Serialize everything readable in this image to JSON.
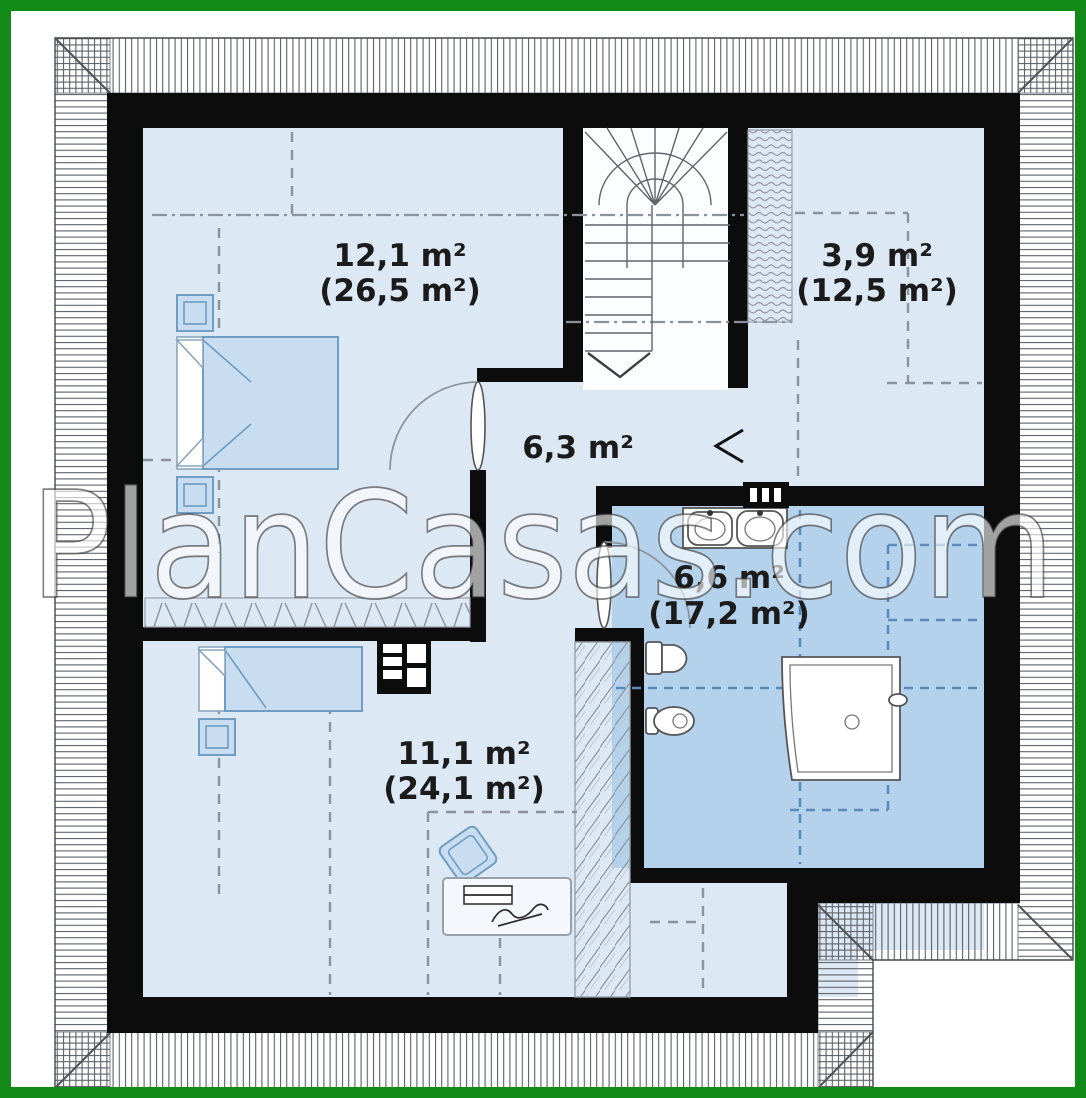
{
  "watermark": "PlanCasas.com",
  "rooms": [
    {
      "name": "bedroom-upper",
      "area": "12,1 m²",
      "floor_area_total": "(26,5 m²)"
    },
    {
      "name": "storage-room",
      "area": "3,9 m²",
      "floor_area_total": "(12,5 m²)"
    },
    {
      "name": "hall",
      "area": "6,3 m²",
      "floor_area_total": ""
    },
    {
      "name": "bathroom",
      "area": "6,6 m²",
      "floor_area_total": "(17,2 m²)"
    },
    {
      "name": "bedroom-lower",
      "area": "11,1 m²",
      "floor_area_total": "(24,1 m²)"
    }
  ],
  "colors": {
    "frame_green": "#128a18",
    "wall_black": "#0c0c0c",
    "floor_light": "#dde8f5",
    "floor_bath": "#b4d2ec",
    "furniture_fill": "#c8ddf0",
    "furniture_stroke": "#6f9cc2",
    "dash_gray": "#8b939e",
    "dash_blue": "#5d89bb",
    "roof_line": "#5b5f66",
    "watermark_fill": "#ffffff"
  }
}
